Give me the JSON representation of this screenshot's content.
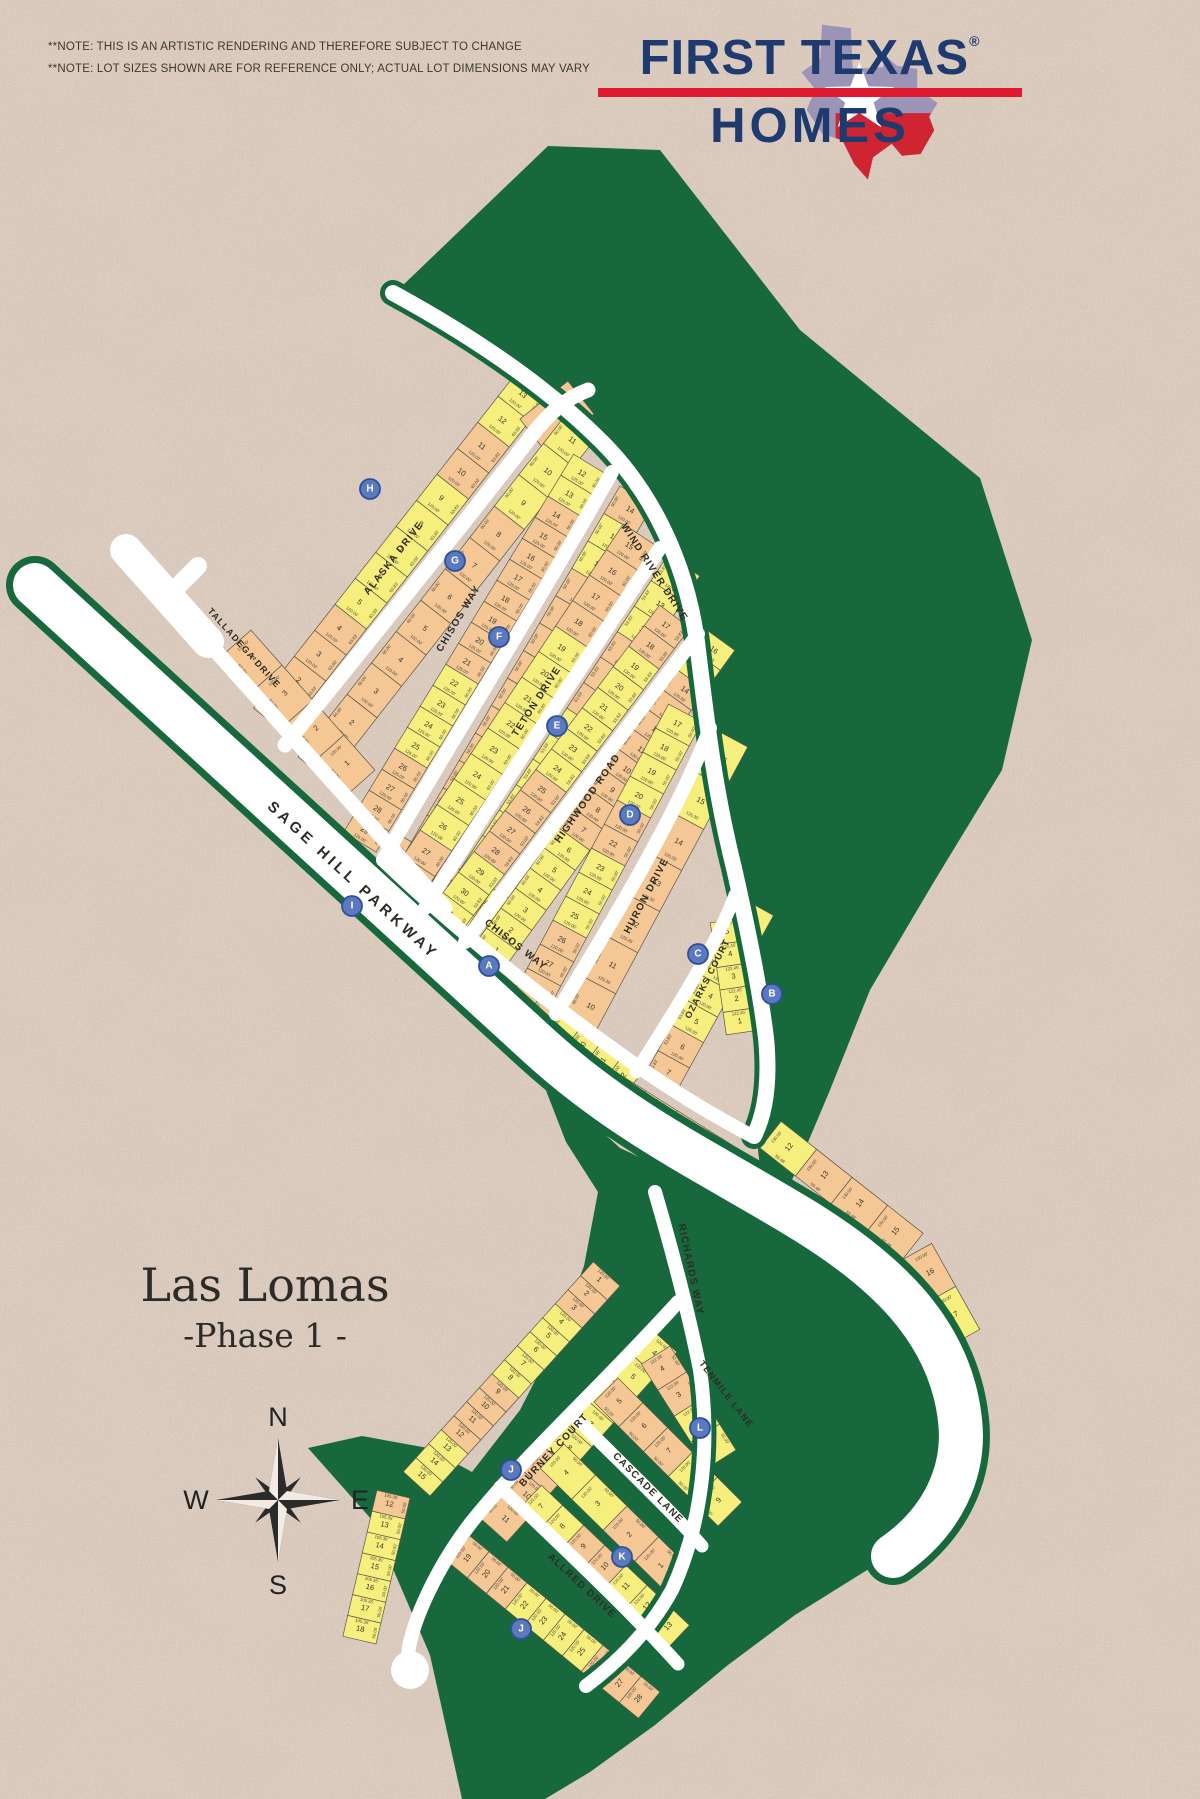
{
  "notes": {
    "line1": "**NOTE: THIS IS AN ARTISTIC RENDERING AND THEREFORE SUBJECT TO CHANGE",
    "line2": "**NOTE: LOT SIZES SHOWN ARE FOR REFERENCE ONLY; ACTUAL LOT DIMENSIONS MAY VARY"
  },
  "logo": {
    "line1": "FIRST TEXAS",
    "reg": "®",
    "line2": "HOMES"
  },
  "title": {
    "name": "Las Lomas",
    "phase": "-Phase 1 -"
  },
  "compass": {
    "n": "N",
    "e": "E",
    "s": "S",
    "w": "W"
  },
  "colors": {
    "bg": "#d8c7b9",
    "green": "#17683c",
    "road": "#ffffff",
    "lotYellow": "#f6ef7d",
    "lotPeach": "#f4c795",
    "lotStroke": "#5a564a",
    "number": "#38342c",
    "dim": "#4a463c",
    "label": "#2f2b24",
    "navy": "#1e3a6e",
    "red": "#e11b2f",
    "markerFill": "#5b79bd",
    "markerStroke": "#2f4f9e",
    "markerText": "#ffffff"
  },
  "map": {
    "greens": [
      "400,288 548,146 660,150 800,330 980,478 1032,640 1002,770 935,880 870,990 830,1090 792,1180 770,1250 758,1150 770,1040 740,870 704,645 612,444",
      "540,1075 620,1148 700,1185 790,1240 880,1292 945,1355 955,1435 935,1510 880,1562 795,1615 728,1665 655,1725 590,1772 545,1799 462,1799 430,1655 372,1520 308,1448 362,1436 428,1448 472,1472 520,1410 556,1340 584,1266 598,1192 566,1142"
    ],
    "roads": [
      {
        "d": "M 35 585 L 538 1045 C 620 1120 700 1158 790 1212 C 885 1268 950 1330 960 1420 C 966 1472 942 1522 893 1556",
        "w": 44,
        "edge": 14
      },
      {
        "d": "M 126 550 L 208 642",
        "w": 32
      },
      {
        "d": "M 174 590 L 198 566",
        "w": 18
      },
      {
        "d": "M 206 640 L 445 908",
        "w": 15
      },
      {
        "d": "M 285 745 C 370 640 462 526 526 443 C 548 413 566 398 588 390",
        "w": 15
      },
      {
        "d": "M 393 293 C 470 335 545 385 602 442 C 652 492 686 562 697 642 C 706 716 714 788 734 868 C 748 930 760 988 766 1038 C 770 1080 766 1112 754 1136",
        "w": 16,
        "edge": 10
      },
      {
        "d": "M 383 860 C 435 768 540 600 612 472",
        "w": 14
      },
      {
        "d": "M 425 908 C 492 800 600 640 660 548",
        "w": 14
      },
      {
        "d": "M 465 942 C 538 845 648 700 698 634",
        "w": 14
      },
      {
        "d": "M 556 1014 C 606 932 676 818 710 728",
        "w": 14
      },
      {
        "d": "M 636 1072 C 674 1012 716 947 735 895",
        "w": 13
      },
      {
        "d": "M 383 860 C 462 936 560 1012 640 1068 C 690 1102 722 1120 752 1136",
        "w": 14
      },
      {
        "d": "M 655 1192 C 672 1250 688 1310 700 1370 C 710 1440 704 1520 672 1590 C 650 1630 618 1662 586 1686",
        "w": 14,
        "edge": 10
      },
      {
        "d": "M 678 1302 C 600 1388 522 1458 470 1524 C 438 1566 412 1620 408 1654",
        "w": 14
      },
      {
        "d": "M 575 1417 C 630 1472 672 1512 702 1546",
        "w": 13
      },
      {
        "d": "M 500 1487 C 560 1545 622 1602 678 1664",
        "w": 13
      }
    ],
    "culdesac": {
      "x": 410,
      "y": 1670,
      "r": 19
    },
    "blocks": [
      {
        "p": [
          285,
          733,
          550,
          395
        ],
        "d": 40,
        "s": 1,
        "f": "63.83'",
        "dm": "120.00'",
        "lots": "1p,2p,3p,4p,5y,6y,7y,8y,9y,10p,11p,12y,13y"
      },
      {
        "p": [
          546,
          452,
          594,
          414
        ],
        "d": 42,
        "s": 1,
        "f": "78.41'",
        "dm": "126.62'",
        "lots": "14p"
      },
      {
        "p": [
          298,
          757,
          568,
          412
        ],
        "d": 38,
        "s": -1,
        "f": "60.00'",
        "dm": "120.00'",
        "lots": "1p,2p,3p,4p,5p,6p,7p,8p,9y,10y,11y"
      },
      {
        "p": [
          376,
          852,
          606,
          474
        ],
        "d": 38,
        "s": 1,
        "f": "60.00'",
        "dm": "125.00'",
        "lots": "29p,28p,27p,26p,25y,24y,23y,22y,21p,20p,19p,18p,17p,16p,15p,14p,13y,12y"
      },
      {
        "p": [
          385,
          868,
          492,
          930
        ],
        "d": 36,
        "s": 1,
        "f": "55.00'",
        "dm": "136.65'",
        "lots": "30p,31p,32y"
      },
      {
        "p": [
          395,
          870,
          620,
          486
        ],
        "d": 38,
        "s": -1,
        "f": "50.00'",
        "dm": "120.00'",
        "lots": "1p,2p,3p,4p,5p,6p,7p,8p,9p,10p,11p,12y,13y,14p"
      },
      {
        "p": [
          418,
          902,
          655,
          545
        ],
        "d": 38,
        "s": 1,
        "f": "60.00'",
        "dm": "120.00'",
        "lots": "28p,27p,26y,25y,24y,23y,22y,21y,20y,19y,18p,17p,16p,15p"
      },
      {
        "p": [
          432,
          912,
          668,
          555
        ],
        "d": 38,
        "s": -1,
        "f": "53.83'",
        "dm": "120.00'",
        "lots": "1y,2y,3y,4y,5y,6y,7y,8y,9p,10p,11p,12y,13y,14y"
      },
      {
        "p": [
          458,
          936,
          690,
          628
        ],
        "d": 38,
        "s": 1,
        "f": "53.83'",
        "dm": "120.00'",
        "lots": "31y,30y,29y,28p,27p,26p,25p,24y,23y,22y,21y,20y,19y,18p,17p"
      },
      {
        "p": [
          472,
          948,
          704,
          628
        ],
        "d": 38,
        "s": -1,
        "f": "50.00'",
        "dm": "120.00'",
        "lots": "1y,2y,3y,4y,5y,6y,7p,8p,9p,10p,11p,12p,13p,14p,15y,16y"
      },
      {
        "p": [
          548,
          1010,
          702,
          722
        ],
        "d": 38,
        "s": 1,
        "f": "50.00'",
        "dm": "120.00'",
        "lots": "28p,27p,26p,25y,24y,23y,22p,21p,20y,19y,18y,17y"
      },
      {
        "p": [
          562,
          1018,
          716,
          730
        ],
        "d": 36,
        "s": -1,
        "f": "58.00'",
        "dm": "125.35'",
        "lots": "10p,11p,12p,13p,14p,15y,16y"
      },
      {
        "p": [
          644,
          1076,
          742,
          898
        ],
        "d": 36,
        "s": -1,
        "f": "53.83'",
        "dm": "120.00'",
        "lots": "7p,6p,5y,4y,3y,2y,1y"
      },
      {
        "p": [
          744,
          918,
          760,
          1030
        ],
        "d": 34,
        "s": -1,
        "f": "55.00'",
        "dm": "122.45'",
        "lots": "5y,4y,3y,2y,1y"
      },
      {
        "p": [
          224,
          654,
          348,
          794
        ],
        "d": 36,
        "s": 1,
        "f": "60.00'",
        "dm": "120.00'",
        "lots": "4p,3p,2p,1p"
      },
      {
        "p": [
          210,
          766,
          300,
          850
        ],
        "d": 34,
        "s": 1,
        "f": "60.04'",
        "dm": "120.00'",
        "lots": "11y,10y,9y,8y,7y"
      },
      {
        "p": [
          300,
          846,
          546,
          1060
        ],
        "d": 34,
        "s": 1,
        "f": "60.04'",
        "dm": "120.00'",
        "lots": "8p,7p,6p,5p,4p,3y,2y,1y"
      },
      {
        "p": [
          404,
          884,
          644,
          1070
        ],
        "d": 34,
        "s": -1,
        "f": "45.00'",
        "dm": "120.00'",
        "lots": "1y,2y,3y,4y,5p,6p,7p,8p,9y,10y,11y,12y"
      },
      {
        "p": [
          552,
          1032,
          740,
          1150
        ],
        "d": 30,
        "s": -1,
        "f": "55.45'",
        "dm": "118.02'",
        "lots": "16y,17y,18p,19p,20p,21p"
      },
      {
        "p": [
          760,
          1148,
          902,
          1260
        ],
        "d": 34,
        "s": 1,
        "f": "55.48'",
        "dm": "130.00'",
        "lots": "12y,13p,14p,15p"
      },
      {
        "p": [
          902,
          1260,
          950,
          1346
        ],
        "d": 34,
        "s": 1,
        "f": "58.45'",
        "dm": "130.00'",
        "lots": "16p,17y"
      },
      {
        "p": [
          620,
          1286,
          430,
          1496
        ],
        "d": 36,
        "s": -1,
        "f": "50.00'",
        "dm": "120.00'",
        "lots": "1p,2p,3p,4y,5y,6y,7y,8y,9p,10p,11p,12p,13y,14y,15y"
      },
      {
        "p": [
          650,
          1328,
          480,
          1518
        ],
        "d": 36,
        "s": 1,
        "f": "50.00'",
        "dm": "120.00'",
        "lots": "4y,5y,6y,7y,8y,9p,10p,11p"
      },
      {
        "p": [
          670,
          1346,
          736,
          1450
        ],
        "d": 34,
        "s": -1,
        "f": "52.00'",
        "dm": "122.58'",
        "lots": "4p,3p,2y,1y"
      },
      {
        "p": [
          594,
          1402,
          718,
          1526
        ],
        "d": 34,
        "s": 1,
        "f": "50.00'",
        "dm": "120.00'",
        "lots": "5p,6p,7p,8y,9y"
      },
      {
        "p": [
          564,
          1444,
          690,
          1568
        ],
        "d": 34,
        "s": -1,
        "f": "50.00'",
        "dm": "120.00'",
        "lots": "4y,3y,2p,1p"
      },
      {
        "p": [
          518,
          1510,
          666,
          1650
        ],
        "d": 34,
        "s": 1,
        "f": "50.00'",
        "dm": "120.00'",
        "lots": "7y,8y,9p,10p,11y,12y,13y"
      },
      {
        "p": [
          470,
          1536,
          660,
          1692
        ],
        "d": 34,
        "s": -1,
        "f": "50.00'",
        "dm": "120.00'",
        "lots": "19p,20p,21p,22y,23y,24y,25y,26p,27p,28p"
      },
      {
        "p": [
          410,
          1498,
          376,
          1644
        ],
        "d": 34,
        "s": -1,
        "f": "50.00'",
        "dm": "105.35'",
        "lots": "12p,13y,14y,15y,16y,17y,18y"
      }
    ],
    "streets": [
      {
        "name": "WIND RIVER DRIVE",
        "x": 652,
        "y": 574,
        "rot": 57,
        "size": 10
      },
      {
        "name": "ALASKA DRIVE",
        "x": 396,
        "y": 560,
        "rot": -52,
        "size": 10
      },
      {
        "name": "CHISOS WAY",
        "x": 461,
        "y": 620,
        "rot": -59,
        "size": 10
      },
      {
        "name": "TETON DRIVE",
        "x": 539,
        "y": 703,
        "rot": -57,
        "size": 10
      },
      {
        "name": "HIGHWOOD ROAD",
        "x": 590,
        "y": 800,
        "rot": -55,
        "size": 10
      },
      {
        "name": "HURON DRIVE",
        "x": 649,
        "y": 897,
        "rot": -62,
        "size": 10
      },
      {
        "name": "OZARKS COURT",
        "x": 710,
        "y": 980,
        "rot": -63,
        "size": 9
      },
      {
        "name": "TALLADEGA DRIVE",
        "x": 242,
        "y": 650,
        "rot": 48,
        "size": 9
      },
      {
        "name": "SAGE HILL PARKWAY",
        "x": 350,
        "y": 884,
        "rot": 42.5,
        "size": 15,
        "ls": 4
      },
      {
        "name": "CHISOS WAY",
        "x": 514,
        "y": 947,
        "rot": 38,
        "size": 10
      },
      {
        "name": "RICHARDS WAY",
        "x": 688,
        "y": 1270,
        "rot": 78,
        "size": 10
      },
      {
        "name": "TENMILE LANE",
        "x": 724,
        "y": 1396,
        "rot": 52,
        "size": 9
      },
      {
        "name": "BURNEY COURT",
        "x": 556,
        "y": 1452,
        "rot": -47,
        "size": 10
      },
      {
        "name": "CASCADE LANE",
        "x": 646,
        "y": 1490,
        "rot": 45,
        "size": 10
      },
      {
        "name": "ALLRED DRIVE",
        "x": 580,
        "y": 1588,
        "rot": 43,
        "size": 10
      }
    ],
    "markers": [
      {
        "letter": "A",
        "x": 489,
        "y": 966
      },
      {
        "letter": "B",
        "x": 772,
        "y": 994
      },
      {
        "letter": "C",
        "x": 698,
        "y": 954
      },
      {
        "letter": "D",
        "x": 630,
        "y": 815
      },
      {
        "letter": "E",
        "x": 557,
        "y": 726
      },
      {
        "letter": "F",
        "x": 499,
        "y": 637
      },
      {
        "letter": "G",
        "x": 455,
        "y": 561
      },
      {
        "letter": "H",
        "x": 370,
        "y": 489
      },
      {
        "letter": "I",
        "x": 352,
        "y": 906
      },
      {
        "letter": "J",
        "x": 511,
        "y": 1470
      },
      {
        "letter": "K",
        "x": 622,
        "y": 1557
      },
      {
        "letter": "L",
        "x": 700,
        "y": 1428
      },
      {
        "letter": "J",
        "x": 521,
        "y": 1629
      }
    ]
  }
}
